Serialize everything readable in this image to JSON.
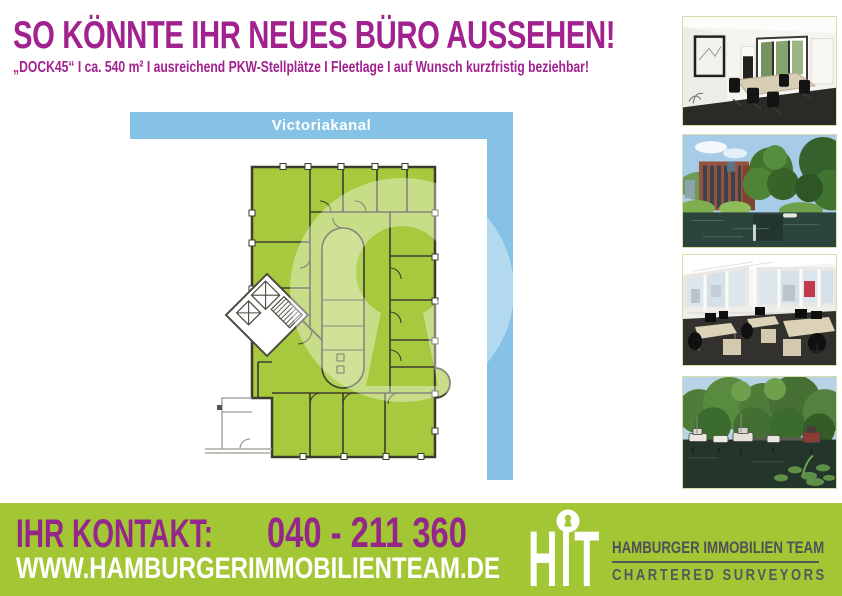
{
  "page": {
    "background": "#ffffff"
  },
  "header": {
    "title": "SO KÖNNTE IHR NEUES BÜRO AUSSEHEN!",
    "subtitle": "„DOCK45“ I ca. 540 m² I ausreichend PKW-Stellplätze I Fleetlage I auf Wunsch kurzfristig beziehbar!",
    "accent_color": "#A1218F"
  },
  "plan": {
    "canal_label": "Victoriakanal",
    "canal_bar_color": "#85C2E5",
    "floor_fill_color": "#A6C93D",
    "watermark_icon": "hit-keyhole-watermark"
  },
  "photos": {
    "border_color": "#D9DCAB",
    "items": [
      {
        "name": "meeting-room-photo"
      },
      {
        "name": "office-building-canal-photo"
      },
      {
        "name": "open-plan-office-photo"
      },
      {
        "name": "canal-boats-photo"
      }
    ]
  },
  "footer": {
    "background": "#A3C634",
    "accent_color": "#95278C",
    "contact_label": "IHR KONTAKT:",
    "phone": "040 - 211 360",
    "website": "WWW.HAMBURGERIMMOBILIENTEAM.DE",
    "logo": {
      "abbr": "HIT",
      "icon": "keyhole-icon",
      "line1": "HAMBURGER IMMOBILIEN TEAM",
      "line2": "CHARTERED SURVEYORS"
    }
  }
}
